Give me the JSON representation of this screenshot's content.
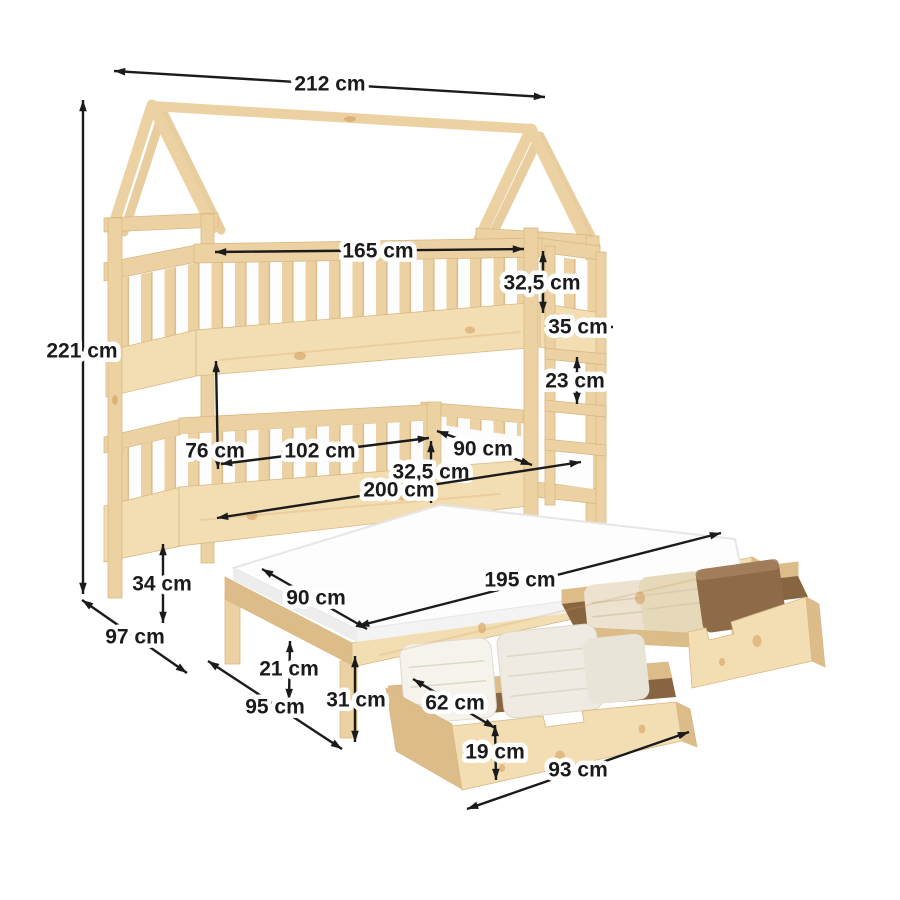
{
  "units": "cm",
  "canvas": {
    "width": 900,
    "height": 900
  },
  "figure": {
    "kind": "furniture-dimension-diagram",
    "subject": "house-frame bunk bed with pull-out trundle bed and two storage drawers"
  },
  "colors": {
    "background": "#ffffff",
    "dim_line": "#1b1b1b",
    "dim_text": "#1b1b1b",
    "wood_light": "#f3deb4",
    "wood_mid": "#ecd2a2",
    "wood_dark": "#dcbc89",
    "knot": "#cf9450",
    "mattress": "#fdfdfd",
    "mattress_shade": "#ededed",
    "drawer_interior": "#876541",
    "linen_cream": "#ece2cf",
    "linen_white": "#f6f3ec",
    "linen_brown": "#8d6b49"
  },
  "dimensions": [
    {
      "name": "roof-ridge-length",
      "label": "212 cm",
      "x1": 114,
      "y1": 71,
      "x2": 545,
      "y2": 97,
      "lx": 330,
      "ly": 84
    },
    {
      "name": "total-height",
      "label": "221 cm",
      "x1": 83,
      "y1": 100,
      "x2": 83,
      "y2": 594,
      "lx": 82,
      "ly": 351
    },
    {
      "name": "upper-bed-length",
      "label": "165 cm",
      "x1": 215,
      "y1": 252,
      "x2": 524,
      "y2": 249,
      "lx": 378,
      "ly": 251
    },
    {
      "name": "upper-guard-height",
      "label": "32,5 cm",
      "x1": 543,
      "y1": 251,
      "x2": 543,
      "y2": 313,
      "lx": 542,
      "ly": 283
    },
    {
      "name": "ladder-width",
      "label": "35 cm",
      "x1": 545,
      "y1": 327,
      "x2": 613,
      "y2": 327,
      "lx": 578,
      "ly": 327
    },
    {
      "name": "ladder-rung-spacing",
      "label": "23 cm",
      "x1": 577,
      "y1": 357,
      "x2": 577,
      "y2": 404,
      "lx": 575,
      "ly": 381
    },
    {
      "name": "bunk-clearance-height",
      "label": "76 cm",
      "x1": 216,
      "y1": 361,
      "x2": 218,
      "y2": 469,
      "lx": 215,
      "ly": 451
    },
    {
      "name": "lower-guard-length",
      "label": "102 cm",
      "x1": 221,
      "y1": 464,
      "x2": 429,
      "y2": 438,
      "lx": 320,
      "ly": 451
    },
    {
      "name": "lower-bed-width",
      "label": "90 cm",
      "x1": 437,
      "y1": 431,
      "x2": 532,
      "y2": 465,
      "lx": 483,
      "ly": 449
    },
    {
      "name": "lower-guard-height",
      "label": "32,5 cm",
      "x1": 431,
      "y1": 441,
      "x2": 431,
      "y2": 503,
      "lx": 431,
      "ly": 472
    },
    {
      "name": "lower-bed-length",
      "label": "200 cm",
      "x1": 217,
      "y1": 518,
      "x2": 581,
      "y2": 462,
      "lx": 399,
      "ly": 490
    },
    {
      "name": "leg-height",
      "label": "34 cm",
      "x1": 163,
      "y1": 544,
      "x2": 163,
      "y2": 623,
      "lx": 162,
      "ly": 584
    },
    {
      "name": "frame-depth",
      "label": "97 cm",
      "x1": 82,
      "y1": 600,
      "x2": 187,
      "y2": 673,
      "lx": 135,
      "ly": 637
    },
    {
      "name": "trundle-mattress-width",
      "label": "90 cm",
      "x1": 262,
      "y1": 569,
      "x2": 367,
      "y2": 629,
      "lx": 316,
      "ly": 598
    },
    {
      "name": "trundle-mattress-length",
      "label": "195 cm",
      "x1": 358,
      "y1": 626,
      "x2": 721,
      "y2": 533,
      "lx": 520,
      "ly": 580
    },
    {
      "name": "trundle-clearance",
      "label": "21 cm",
      "x1": 290,
      "y1": 641,
      "x2": 289,
      "y2": 700,
      "lx": 289,
      "ly": 669
    },
    {
      "name": "trundle-depth",
      "label": "95 cm",
      "x1": 208,
      "y1": 661,
      "x2": 342,
      "y2": 749,
      "lx": 275,
      "ly": 707
    },
    {
      "name": "trundle-frame-height",
      "label": "31 cm",
      "x1": 355,
      "y1": 656,
      "x2": 355,
      "y2": 742,
      "lx": 356,
      "ly": 700
    },
    {
      "name": "drawer-inner-width",
      "label": "62 cm",
      "x1": 413,
      "y1": 679,
      "x2": 495,
      "y2": 728,
      "lx": 455,
      "ly": 703
    },
    {
      "name": "drawer-height",
      "label": "19 cm",
      "x1": 495,
      "y1": 725,
      "x2": 496,
      "y2": 780,
      "lx": 495,
      "ly": 752
    },
    {
      "name": "drawer-length",
      "label": "93 cm",
      "x1": 467,
      "y1": 809,
      "x2": 689,
      "y2": 732,
      "lx": 578,
      "ly": 770
    }
  ]
}
